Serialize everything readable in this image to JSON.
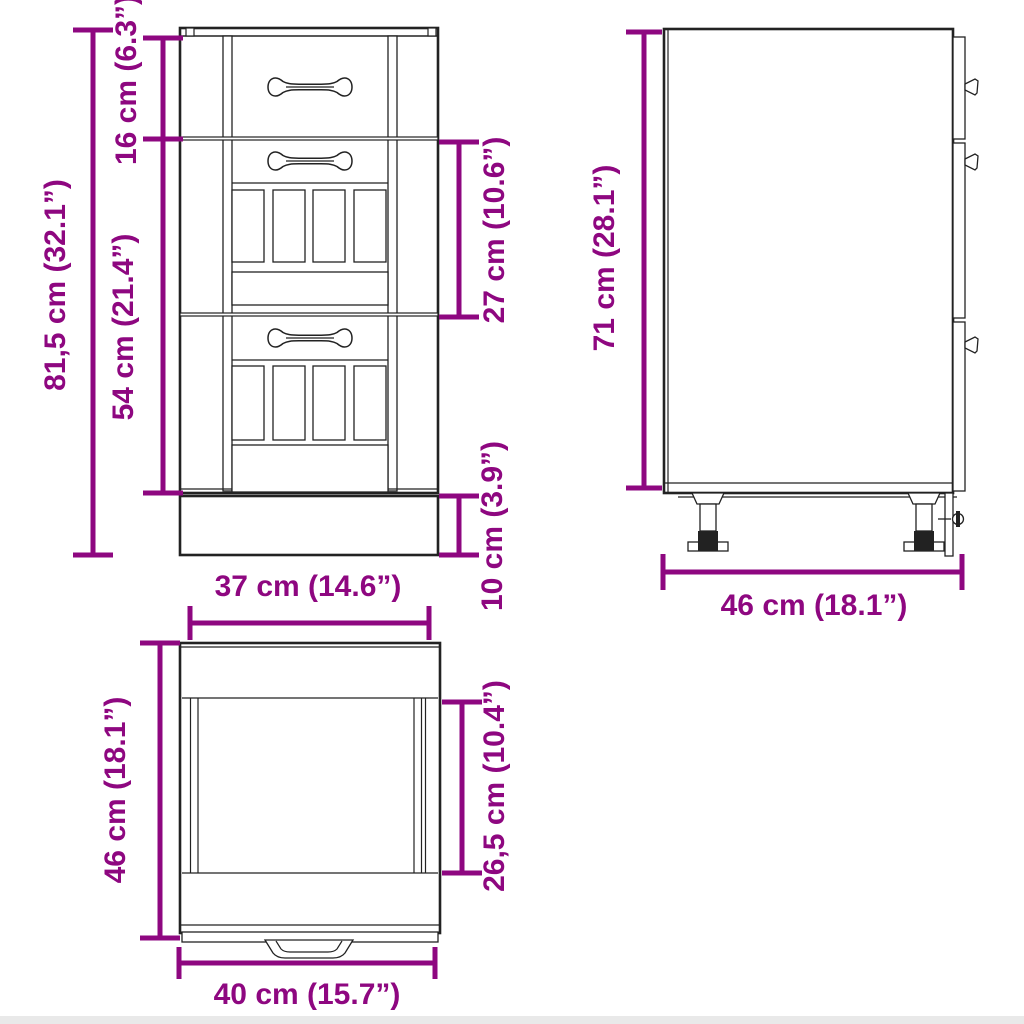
{
  "diagram": {
    "title": "cabinet-dimension-diagram",
    "colors": {
      "dimension_accent": "#8E0780",
      "line_art": "#222222",
      "background": "#FFFFFF"
    },
    "dims": {
      "front_overall_height": {
        "label": "81,5 cm (32.1”)",
        "cm": "81,5",
        "inch": "32.1"
      },
      "front_top_drawer_height": {
        "label": "16 cm (6.3”)",
        "cm": "16",
        "inch": "6.3"
      },
      "front_lower_drawers_height": {
        "label": "54 cm (21.4”)",
        "cm": "54",
        "inch": "21.4"
      },
      "front_middle_drawer_height": {
        "label": "27 cm (10.6”)",
        "cm": "27",
        "inch": "10.6"
      },
      "front_plinth_height": {
        "label": "10 cm (3.9”)",
        "cm": "10",
        "inch": "3.9"
      },
      "front_width": {
        "label": "37 cm (14.6”)",
        "cm": "37",
        "inch": "14.6"
      },
      "side_height": {
        "label": "71 cm (28.1”)",
        "cm": "71",
        "inch": "28.1"
      },
      "side_depth": {
        "label": "46 cm (18.1”)",
        "cm": "46",
        "inch": "18.1"
      },
      "top_view_depth": {
        "label": "46 cm (18.1”)",
        "cm": "46",
        "inch": "18.1"
      },
      "top_view_inner_depth": {
        "label": "26,5 cm (10.4”)",
        "cm": "26,5",
        "inch": "10.4"
      },
      "top_view_width": {
        "label": "40 cm (15.7”)",
        "cm": "40",
        "inch": "15.7"
      }
    }
  }
}
